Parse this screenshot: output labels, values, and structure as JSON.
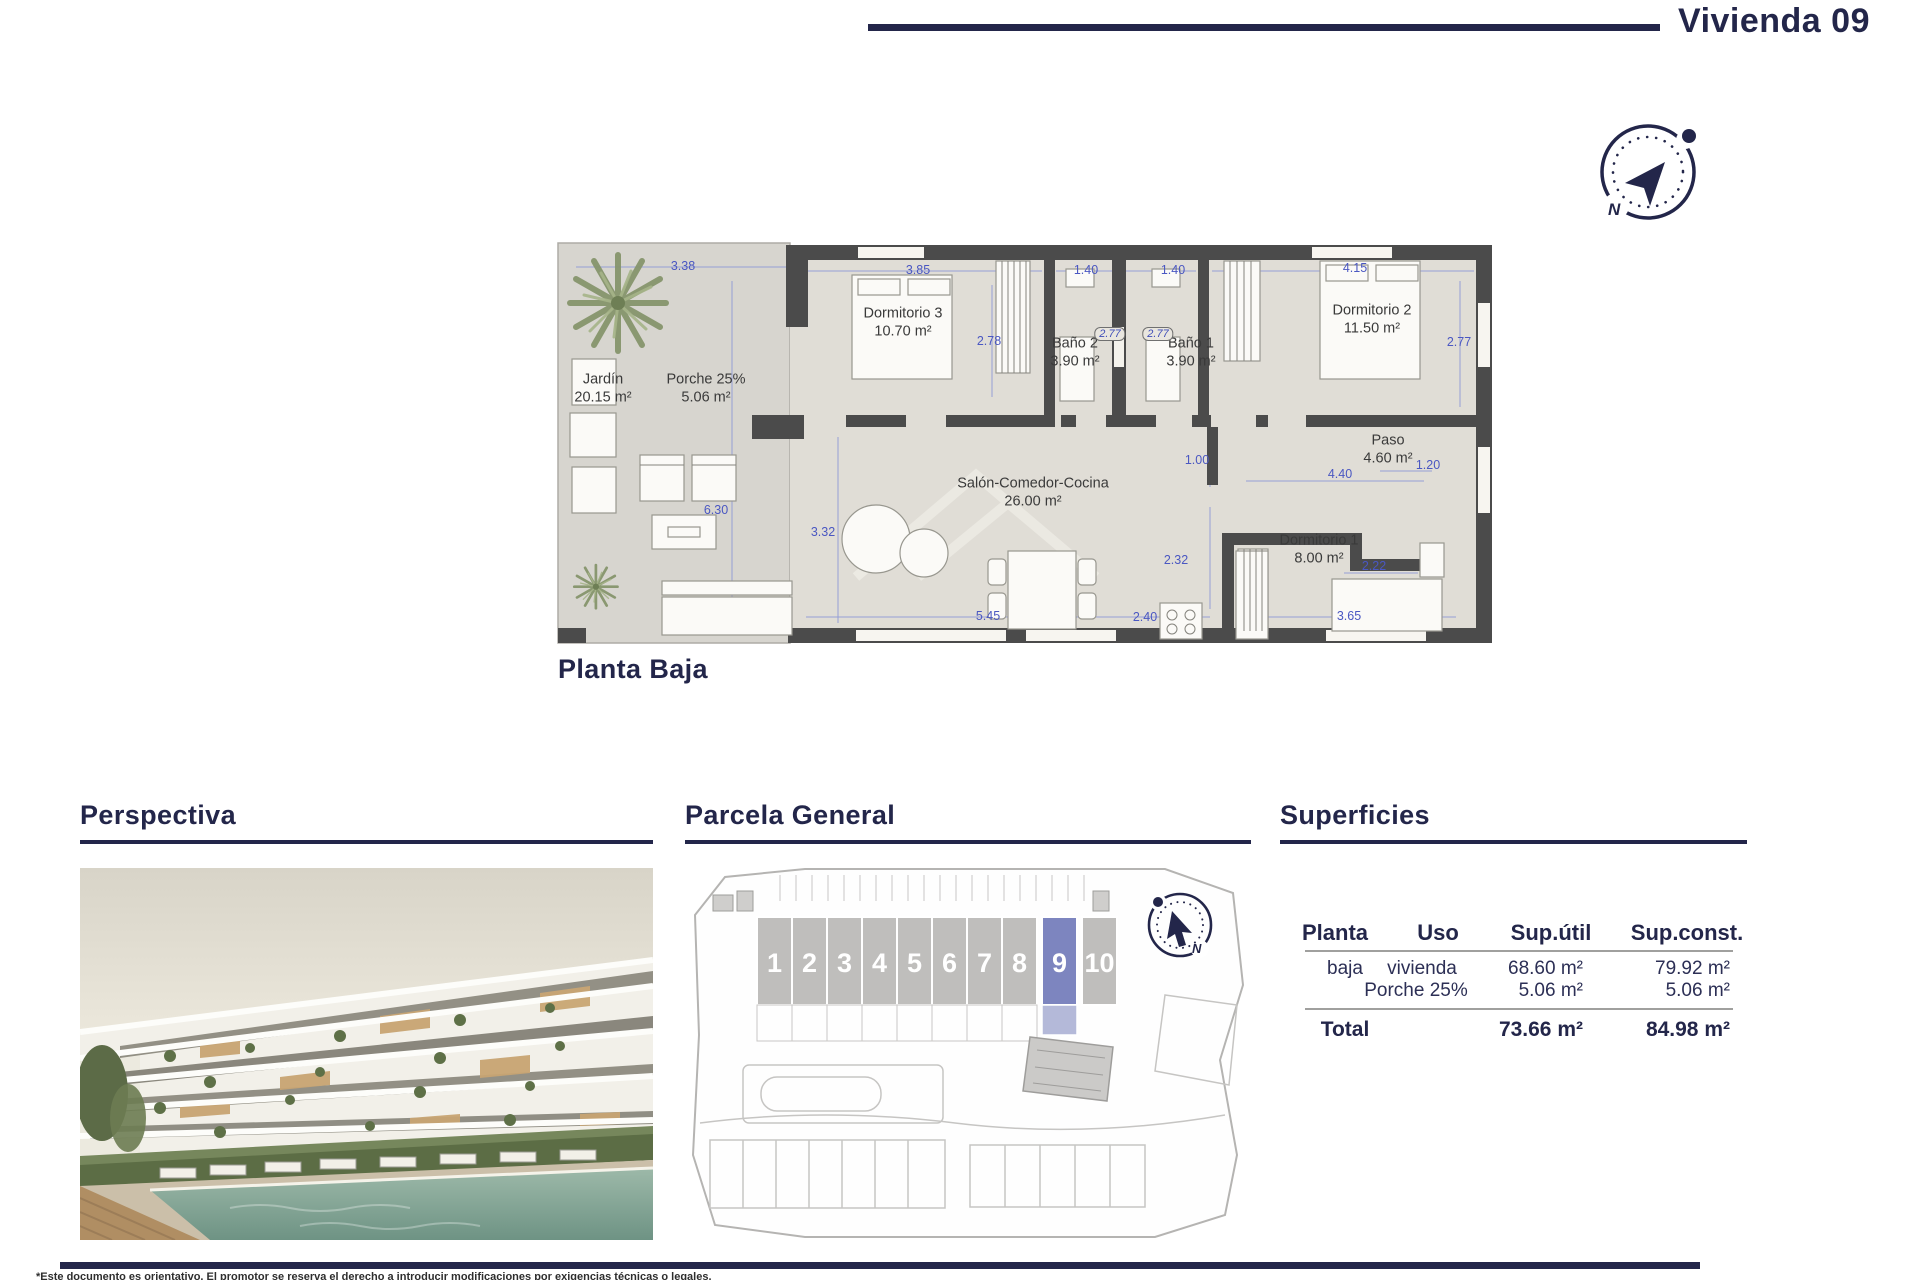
{
  "header": {
    "title": "Vivienda 09"
  },
  "compass": {
    "north": "N"
  },
  "floorplan": {
    "caption": "Planta Baja",
    "rooms": [
      {
        "name": "Jardín",
        "area": "20.15 m²"
      },
      {
        "name": "Porche 25%",
        "area": "5.06 m²"
      },
      {
        "name": "Dormitorio 3",
        "area": "10.70 m²"
      },
      {
        "name": "Baño 2",
        "area": "3.90 m²"
      },
      {
        "name": "Baño 1",
        "area": "3.90 m²"
      },
      {
        "name": "Dormitorio 2",
        "area": "11.50 m²"
      },
      {
        "name": "Paso",
        "area": "4.60 m²"
      },
      {
        "name": "Salón-Comedor-Cocina",
        "area": "26.00 m²"
      },
      {
        "name": "Dormitorio 1",
        "area": "8.00 m²"
      }
    ],
    "dimensions": [
      "3.38",
      "3.85",
      "1.40",
      "1.40",
      "4.15",
      "2.78",
      "2.77",
      "2.77",
      "2.77",
      "6.30",
      "3.32",
      "1.00",
      "4.40",
      "1.20",
      "2.32",
      "2.22",
      "5.45",
      "2.40",
      "3.65"
    ]
  },
  "perspectiva": {
    "title": "Perspectiva"
  },
  "parcela": {
    "title": "Parcela General",
    "units": [
      "1",
      "2",
      "3",
      "4",
      "5",
      "6",
      "7",
      "8",
      "9",
      "10"
    ],
    "highlighted_unit": "9"
  },
  "superficies": {
    "title": "Superficies",
    "headers": [
      "Planta",
      "Uso",
      "Sup.útil",
      "Sup.const."
    ],
    "rows": [
      {
        "planta": "baja",
        "uso": "vivienda",
        "sup_util": "68.60 m²",
        "sup_const": "79.92 m²"
      },
      {
        "planta": "",
        "uso": "Porche 25%",
        "sup_util": "5.06 m²",
        "sup_const": "5.06 m²"
      }
    ],
    "total": {
      "label": "Total",
      "sup_util": "73.66 m²",
      "sup_const": "84.98 m²"
    }
  },
  "footer": {
    "disclaimer": "*Este documento es orientativo. El promotor se reserva el derecho a introducir modificaciones por exigencias técnicas o legales."
  },
  "colors": {
    "navy": "#23264a",
    "dimension_blue": "#4a57c2",
    "wall_gray": "#4b4b4b",
    "floor": "#dfdcd5",
    "unit_highlight": "#7d85bf"
  }
}
